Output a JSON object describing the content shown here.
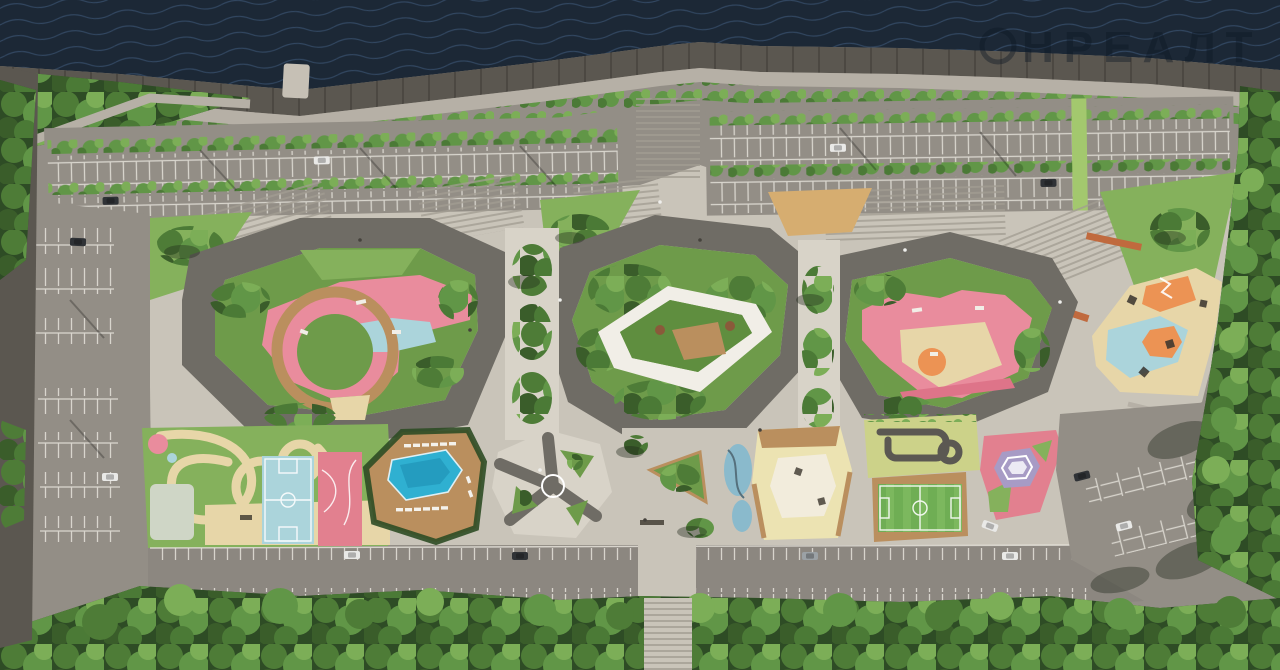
{
  "meta": {
    "description": "Aerial 3D render of a riverside residential complex masterplan: embankment promenade, tree-lined parking lots, three landscaped courtyards with pink playgrounds, outdoor pool, sports courts, mini football pitch, traffic-training town and surrounding forest"
  },
  "watermark": {
    "text": "НРЕАЛТ"
  },
  "palette": {
    "water": "#1c2836",
    "ripple": "#3e5878",
    "revetment": "#5b5750",
    "revetmentJoint": "rgba(0,0,0,0.22)",
    "promenade": "#b6b0a6",
    "pier": "#c6c0b5",
    "asphalt": "#938e86",
    "road": "#8c8780",
    "stallLine": "#eae7df",
    "plaza": "#c9c4b9",
    "plazaBright": "#d8d3c8",
    "stepLine": "#a19c91",
    "roof": "#6f6c65",
    "roofDark": "#605d56",
    "lawn": "#85b15c",
    "lawnDark": "#6e9b4a",
    "garden": "#5f8e3f",
    "treeLight": "#7cae57",
    "treeMid": "#619647",
    "treeDark": "#4b7a36",
    "forestMid": "#4e7c37",
    "forestDark": "#3a5d2a",
    "forestBase": "#2e4c25",
    "shadow": "rgba(30,36,24,0.38)",
    "sand": "#e7d6a8",
    "sandLight": "#f0e7cd",
    "wood": "#ba8f5e",
    "woodDark": "#9c7343",
    "woodLight": "#d6ad70",
    "pink": "#e98c9d",
    "pinkDeep": "#de7489",
    "courtPink": "#e2808f",
    "babyBlue": "#abd4db",
    "poolBlue": "#2fb0d1",
    "poolDeep": "#1b8cb0",
    "orange": "#ec9354",
    "rust": "#c06a3e",
    "yellowPad": "#ece3b2",
    "padWhite": "#f2ecdc",
    "trafficGreen": "#ccd289",
    "pitchGreen": "#6fae54",
    "pitchLight": "#85c065",
    "purple": "#a79bc5",
    "purpleLight": "#eceaf4",
    "white": "#f1eee7",
    "track": "#5b5852",
    "blueSplash": "#7fb9cf",
    "greenMedian": "#a3c86e",
    "canopy": "#cfd6c6",
    "carWhite": "#e9e9e7",
    "carDark": "#2f3236",
    "carSilver": "#9ba1a5",
    "watermarkColor": "rgba(13,23,35,0.40)"
  }
}
